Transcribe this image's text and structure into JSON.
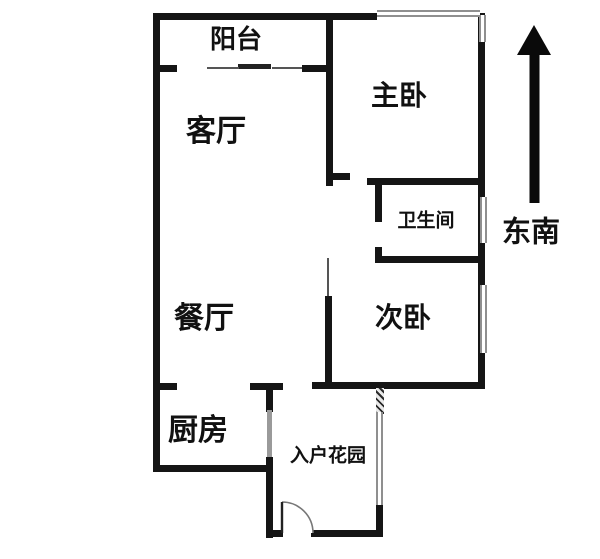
{
  "title": "apartment-floor-plan",
  "colors": {
    "wall": "#151515",
    "window_gray": "#8f8f8f",
    "background": "#ffffff",
    "text": "#111111",
    "arrow": "#0a0a0a"
  },
  "rooms": {
    "balcony": {
      "label": "阳台"
    },
    "living_room": {
      "label": "客厅"
    },
    "master_bedroom": {
      "label": "主卧"
    },
    "bathroom": {
      "label": "卫生间"
    },
    "second_bedroom": {
      "label": "次卧"
    },
    "dining_room": {
      "label": "餐厅"
    },
    "kitchen": {
      "label": "厨房"
    },
    "entry_garden": {
      "label": "入户花园"
    }
  },
  "compass": {
    "label": "东南",
    "arrow_direction": "up"
  }
}
